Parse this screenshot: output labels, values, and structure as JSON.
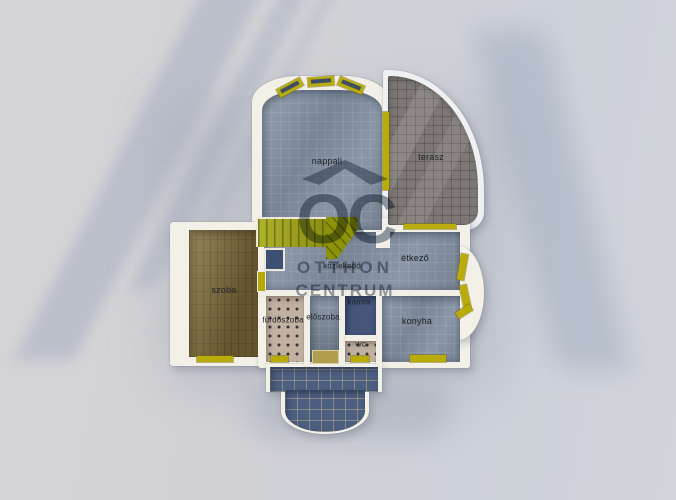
{
  "watermark": {
    "monogram": "OC",
    "line1": "OTTHON",
    "line2": "CENTRUM"
  },
  "rooms": {
    "nappali": "nappali",
    "terasz": "terasz",
    "szoba": "szoba",
    "kozlekedo": "közlekedő",
    "etkezo": "étkező",
    "furdoszoba": "fürdőszoba",
    "eloszoba": "előszoba",
    "kamra": "kamra",
    "konyha": "konyha",
    "wc": "WC"
  },
  "colors": {
    "background": "#d3d2d6",
    "wall_white": "#f3f0e8",
    "floor_blue_gray": "#8390a2",
    "floor_dark_blue": "#4d5f81",
    "terrace_gray_brown": "#7d7875",
    "wood_brown": "#7c6b3e",
    "tile_beige": "#c1b1a1",
    "stair_olive": "#a0a40e",
    "window_yellow": "#b8ab0a",
    "watermark_slate": "#3e5068"
  }
}
